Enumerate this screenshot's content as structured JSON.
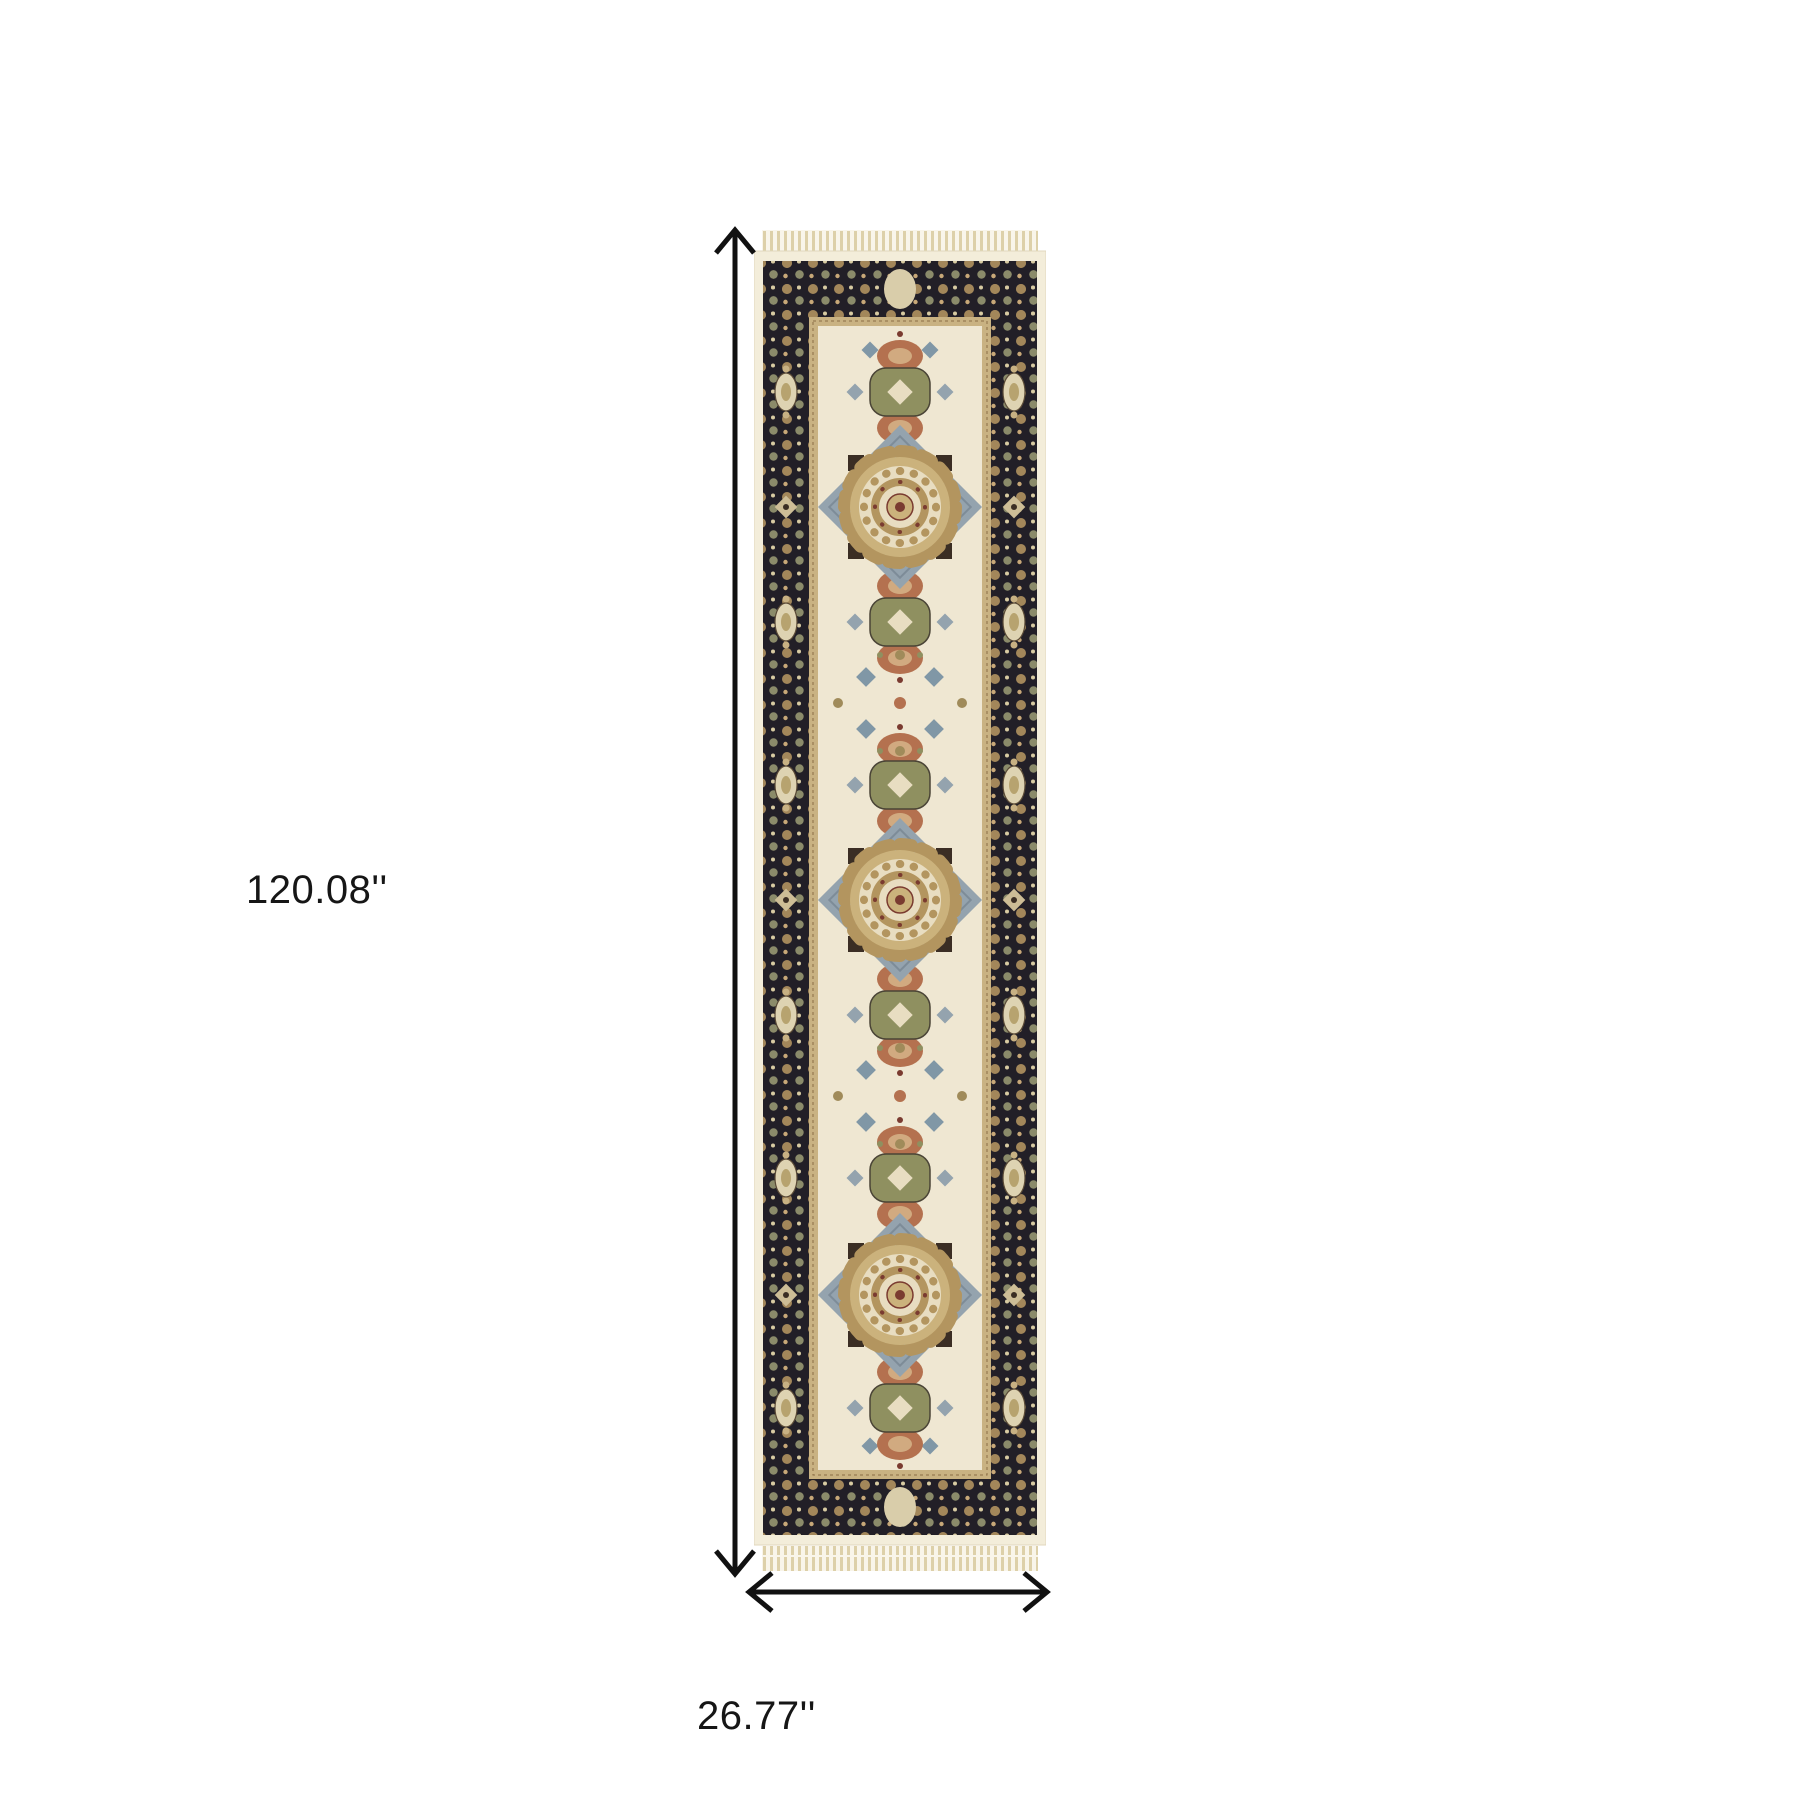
{
  "dimensions": {
    "height_label": "120.08''",
    "width_label": "26.77''"
  },
  "colors": {
    "background": "#ffffff",
    "arrow": "#111111",
    "label_text": "#161616",
    "rug_outer_cream": "#f3edda",
    "rug_border_dark": "#221f27",
    "rug_guard_tan": "#c9b282",
    "rug_field_ivory": "#efe7d2",
    "rug_gold": "#b3955f",
    "rug_gold_light": "#cbb27c",
    "rug_cream_motif": "#e8ddc1",
    "rug_rust": "#b4714f",
    "rug_sage": "#8f9060",
    "rug_blue_grey": "#94a3ae",
    "rug_maroon": "#7a3b30",
    "rug_fringe": "#ddd0a9"
  }
}
